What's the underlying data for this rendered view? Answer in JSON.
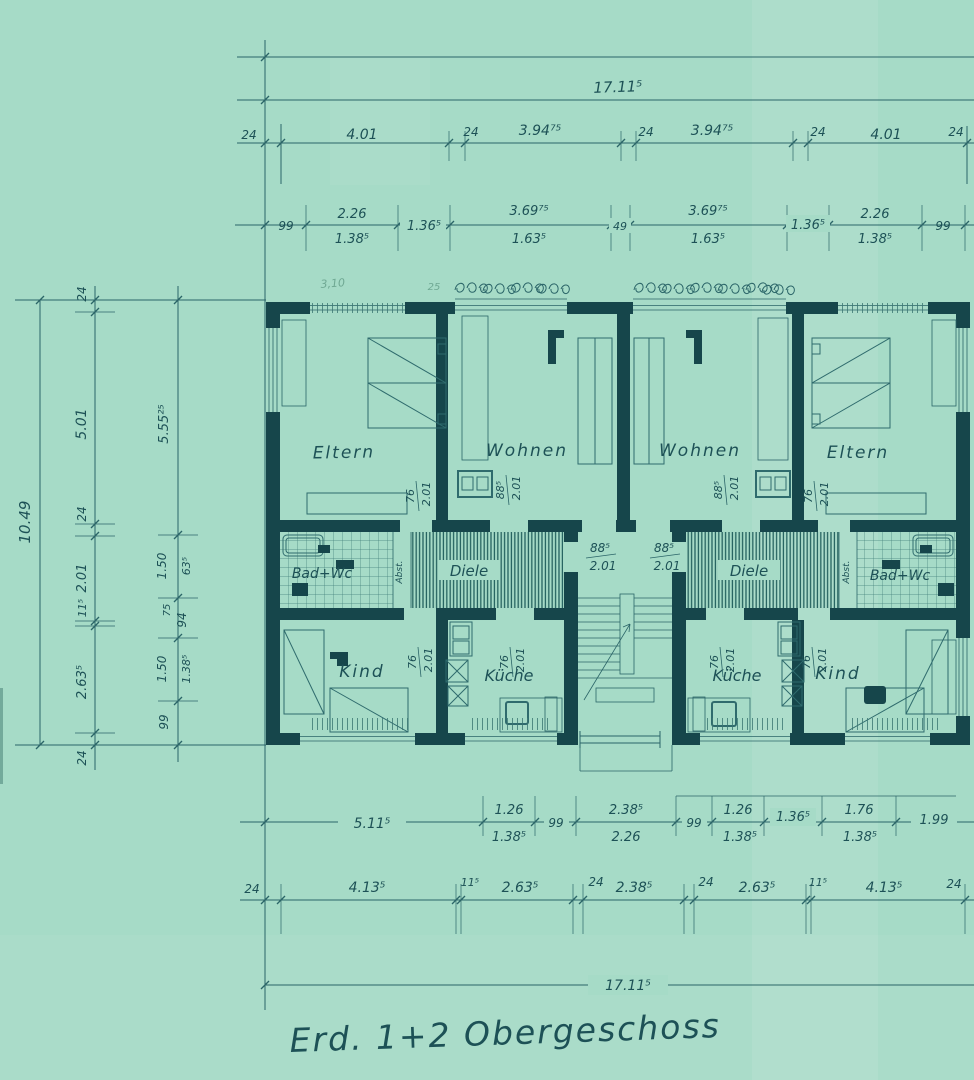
{
  "title": "Erd. 1+2 Obergeschoss",
  "colors": {
    "paper": "#a6dbc7",
    "wall_ink": "#16464b",
    "line_ink": "#2b6568",
    "text_ink": "#1d5156",
    "pencil": "#6fa893"
  },
  "pencil_notes": {
    "a": "3,10",
    "b": "25"
  },
  "dims": {
    "top": {
      "total": "17.11⁵",
      "axes": [
        "24",
        "4.01",
        "24",
        "3.94⁷⁵",
        "24",
        "3.94⁷⁵",
        "24",
        "4.01",
        "24"
      ],
      "openings": [
        "99",
        "2.26",
        "1.38⁵",
        "1.36⁵",
        "3.69⁷⁵",
        "1.63⁵",
        "49",
        "3.69⁷⁵",
        "1.63⁵",
        "1.36⁵",
        "2.26",
        "1.38⁵",
        "99"
      ]
    },
    "left": {
      "total": "10.49",
      "axes": [
        "24",
        "5.01",
        "24",
        "2.01",
        "11⁵",
        "2.63⁵",
        "24"
      ],
      "inner": [
        "5.55²⁵",
        "1.50",
        "63⁵",
        "75",
        "94",
        "1.50",
        "1.38⁵",
        "99"
      ]
    },
    "bottom": {
      "row1": [
        "5.11⁵",
        "1.26",
        "1.38⁵",
        "99",
        "2.38⁵",
        "2.26",
        "99",
        "1.26",
        "1.38⁵",
        "1.36⁵",
        "1.76",
        "1.38⁵",
        "1.99"
      ],
      "row2": [
        "24",
        "4.13⁵",
        "11⁵",
        "2.63⁵",
        "24",
        "2.38⁵",
        "24",
        "2.63⁵",
        "11⁵",
        "4.13⁵",
        "24"
      ],
      "total": "17.11⁵"
    },
    "doors": {
      "w76": "76",
      "w885": "88⁵",
      "h": "2.01"
    }
  },
  "rooms": {
    "eltern_l": "Eltern",
    "wohnen_l": "Wohnen",
    "wohnen_r": "Wohnen",
    "eltern_r": "Eltern",
    "bad_l": "Bad+Wc",
    "diele_l": "Diele",
    "diele_r": "Diele",
    "bad_r": "Bad+Wc",
    "kind_l": "Kind",
    "kueche_l": "Küche",
    "kueche_r": "Küche",
    "kind_r": "Kind",
    "abst_l": "Abst.",
    "abst_r": "Abst."
  }
}
